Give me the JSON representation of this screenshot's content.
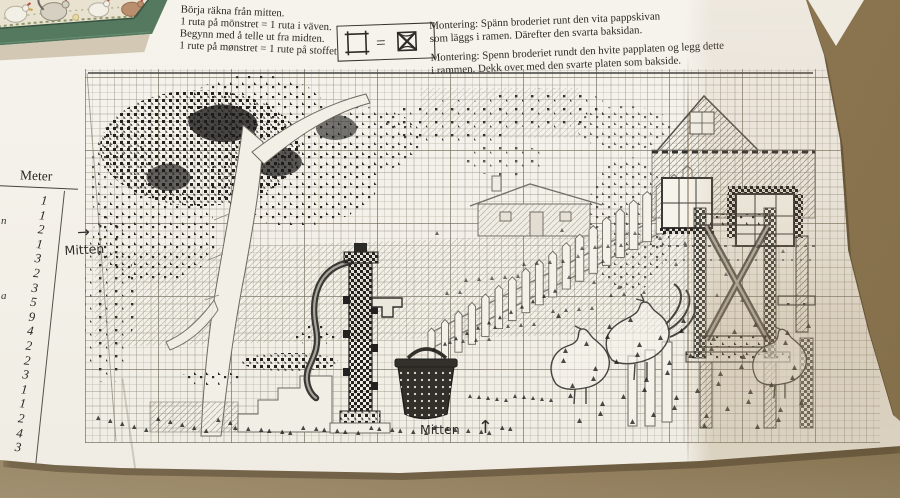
{
  "sheet": {
    "instructions": {
      "lines": [
        "Börja räkna från mitten.",
        "1 ruta på mönstret = 1 ruta i väven.",
        "Begynn med å telle ut fra midten.",
        "1 rute på mønstret = 1 rute på stoffet."
      ]
    },
    "legend": {
      "equals_sign": "="
    },
    "mounting": {
      "sv_line1": "Montering: Spänn broderiet runt den vita pappskivan",
      "sv_line2": "som läggs i ramen. Därefter den svarta baksidan.",
      "no_line1": "Montering: Spenn broderiet rundt den hvite papplaten og legg dette",
      "no_line2": "i rammen. Dekk over med den svarte platen som bakside."
    },
    "thread_table": {
      "header": "Meter",
      "values": [
        "1",
        "1",
        "2",
        "1",
        "3",
        "2",
        "3",
        "5",
        "9",
        "4",
        "2",
        "2",
        "3",
        "1",
        "1",
        "2",
        "4",
        "3"
      ],
      "edge_letters": [
        "n",
        "a"
      ]
    },
    "center_marks": {
      "left_label": "Mitten",
      "left_arrow": "→",
      "bottom_label": "Mitten",
      "bottom_arrow": "↑"
    }
  },
  "colors": {
    "table_brown": "#8e7a56",
    "paper": "#f3f0e8",
    "frame_green": "#54795f",
    "ink": "#2b2824",
    "grid_line": "#bdb7aa"
  }
}
